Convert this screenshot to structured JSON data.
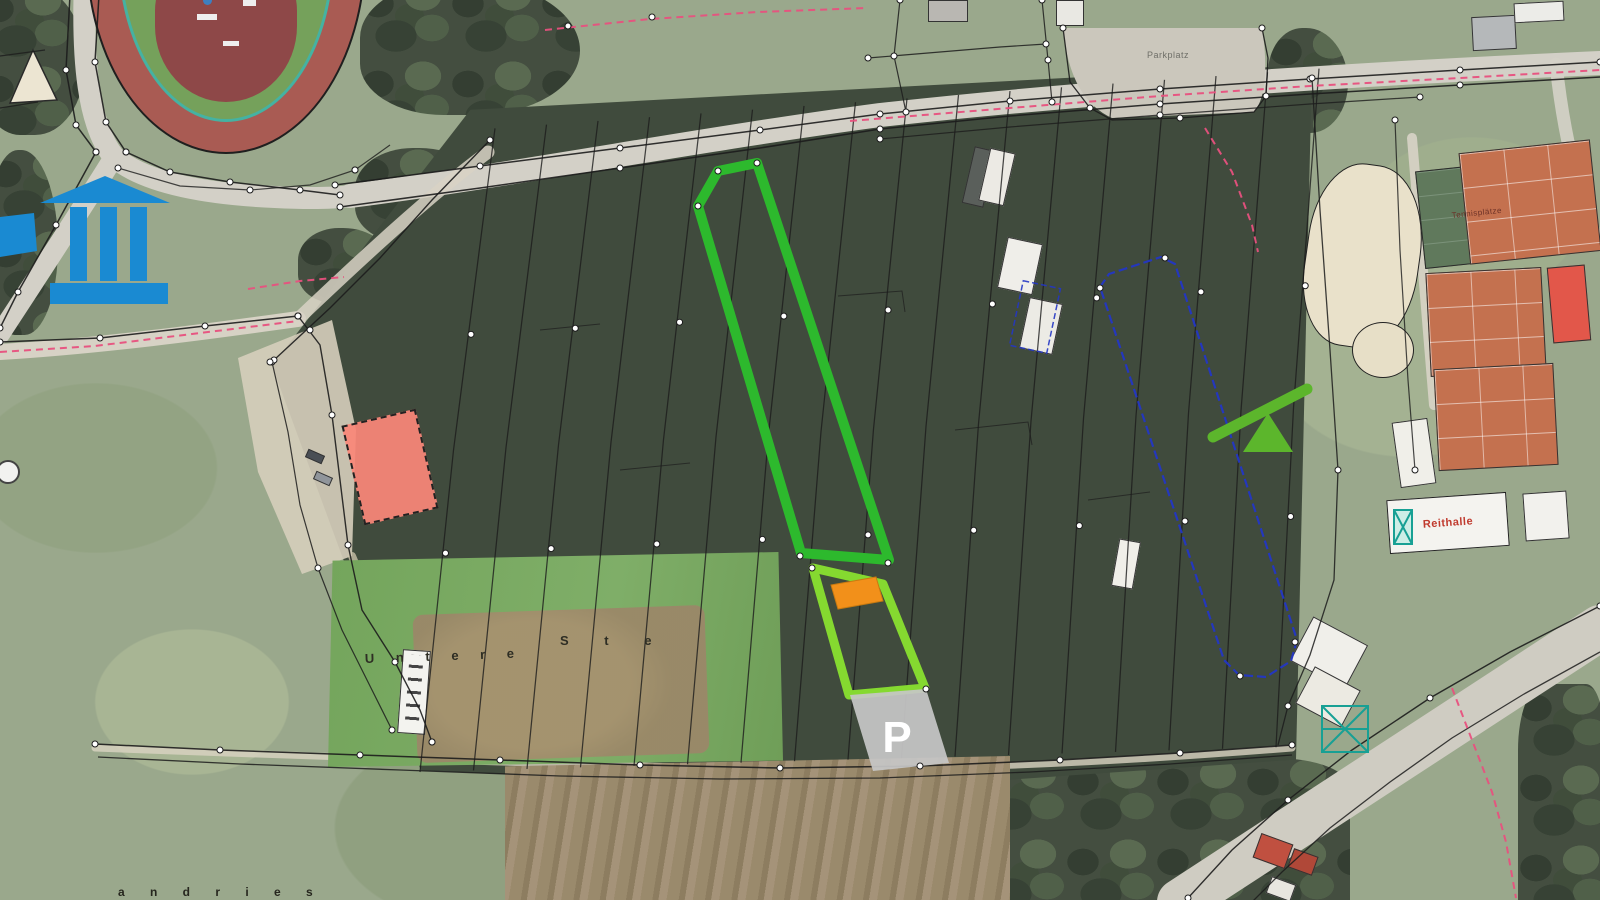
{
  "map": {
    "labels": {
      "parking_lot": "Parkplatz",
      "parking_marker": "P",
      "tennis_courts": "Tennisplätze",
      "riding_hall": "Reithalle",
      "field_name_part1": "U n t e r e",
      "field_name_part2": "S t e",
      "field_name_bottom": "a n d r i e s"
    },
    "colors": {
      "highlight_green": "#2db92d",
      "highlight_lime": "#85d930",
      "highlight_orange": "#f2901a",
      "parcel_blue": "#2336c4",
      "boundary_pink": "#e8507e",
      "parking_gray": "#c6c6c6",
      "area_salmon": "#f9897d",
      "icon_blue": "#1a8ad2",
      "icon_green": "#5cb62c",
      "cadastral_black": "#1c1c1c",
      "court_clay": "#c4714f",
      "label_red": "#c03a2e"
    },
    "icons": [
      {
        "name": "monument-icon",
        "meaning": "public building landmark marker"
      },
      {
        "name": "seesaw-icon",
        "meaning": "playground marker"
      }
    ],
    "overlays": [
      {
        "name": "parcel-outline-green",
        "color": "#2db92d"
      },
      {
        "name": "parcel-outline-lime",
        "color": "#85d930"
      },
      {
        "name": "building-footprint-orange",
        "color": "#f2901a"
      },
      {
        "name": "parking-area-gray",
        "label": "P",
        "color": "#c6c6c6"
      },
      {
        "name": "parcel-outline-blue",
        "color": "#2336c4"
      },
      {
        "name": "court-area-salmon",
        "color": "#f9897d"
      }
    ]
  }
}
